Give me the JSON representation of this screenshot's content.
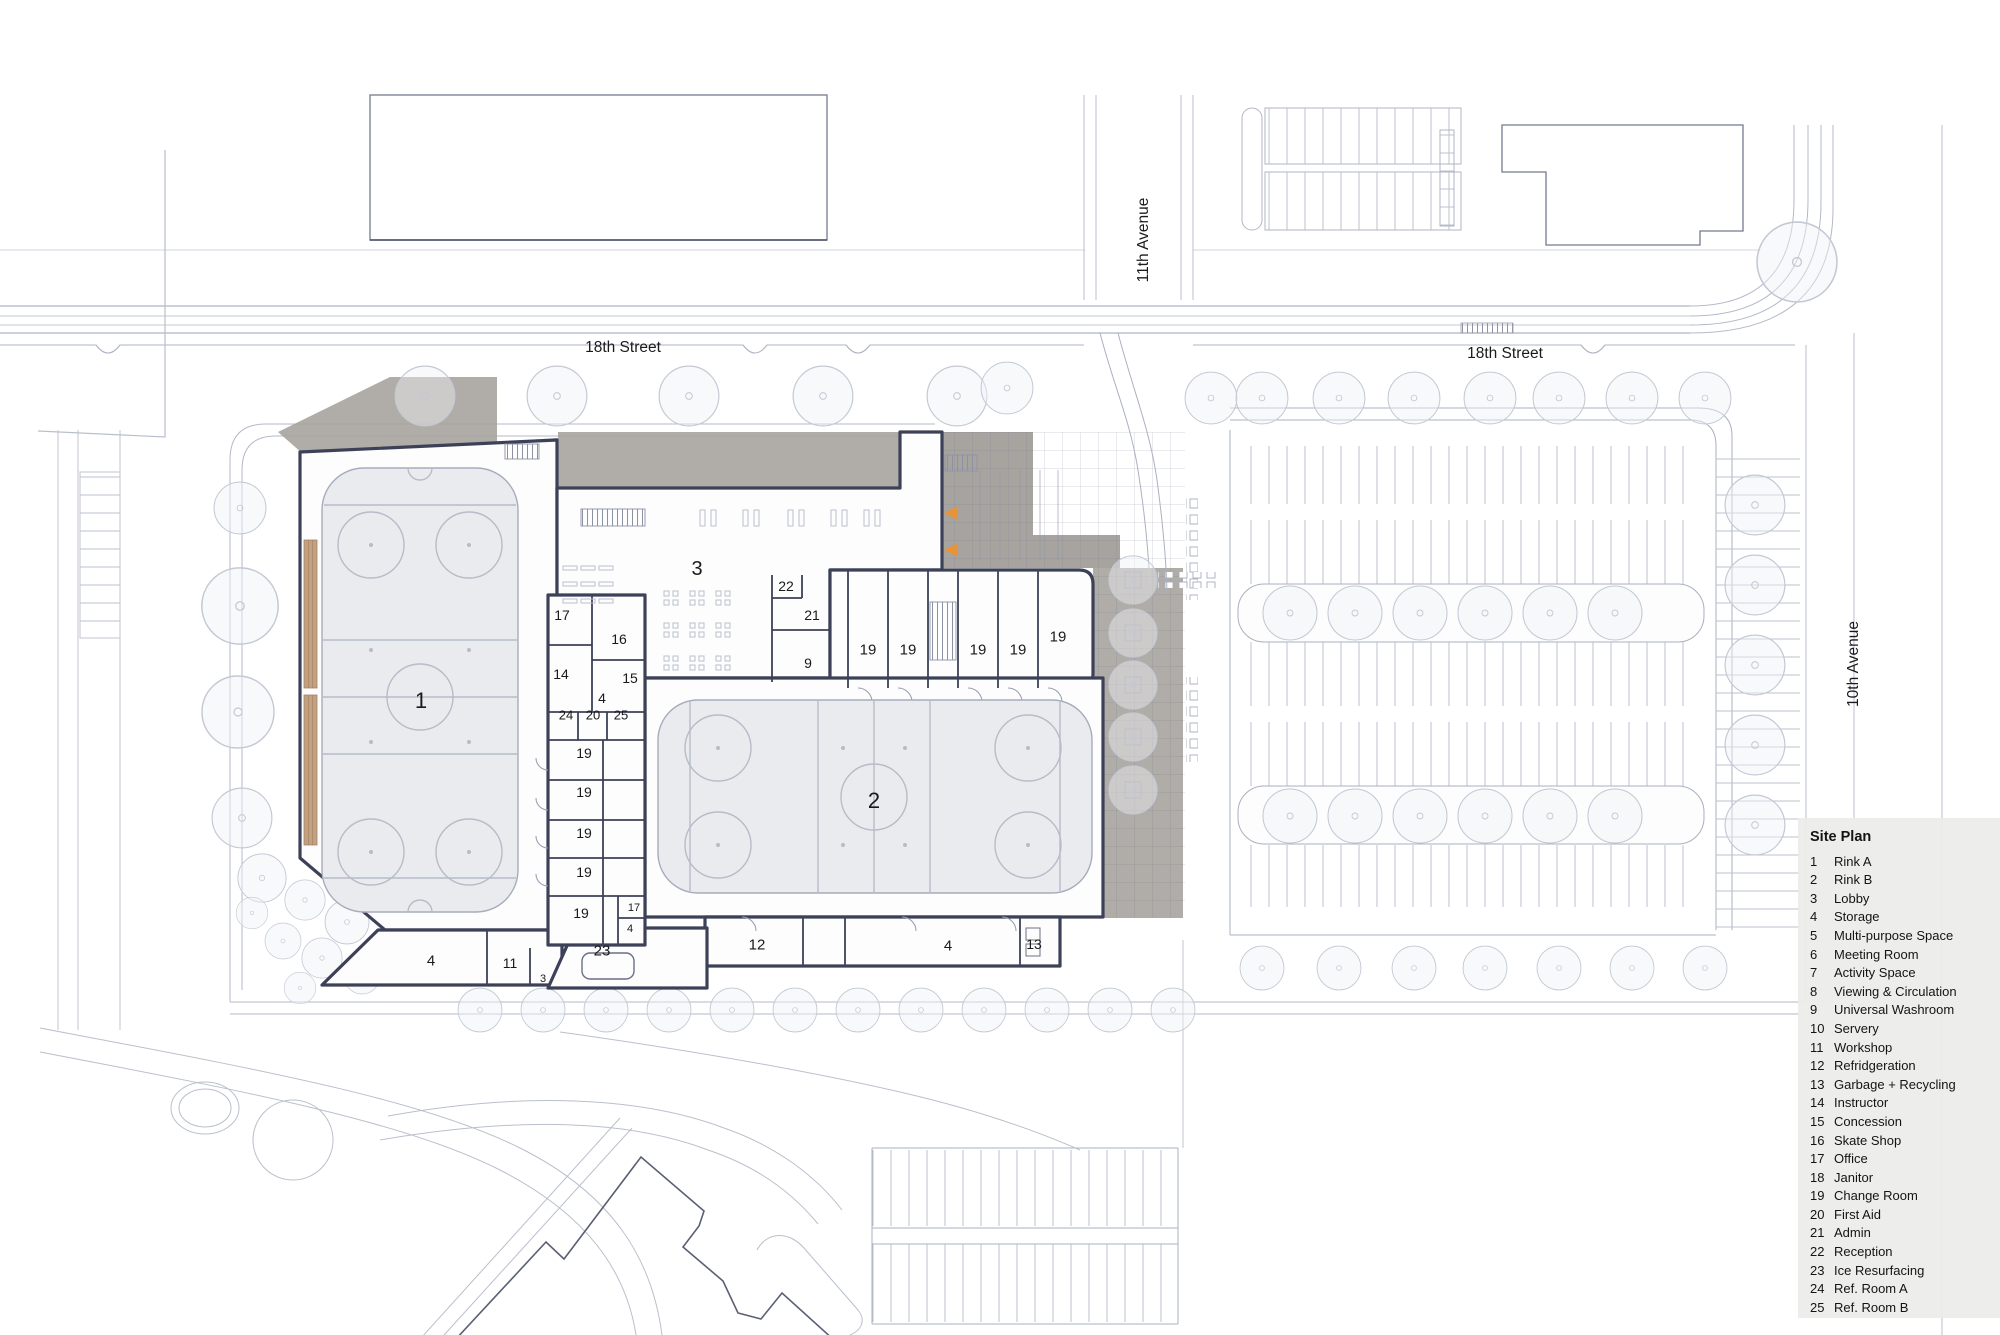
{
  "legend": {
    "title": "Site Plan",
    "items": [
      [
        "1",
        "Rink A"
      ],
      [
        "2",
        "Rink B"
      ],
      [
        "3",
        "Lobby"
      ],
      [
        "4",
        "Storage"
      ],
      [
        "5",
        "Multi-purpose Space"
      ],
      [
        "6",
        "Meeting Room"
      ],
      [
        "7",
        "Activity Space"
      ],
      [
        "8",
        "Viewing & Circulation"
      ],
      [
        "9",
        "Universal Washroom"
      ],
      [
        "10",
        "Servery"
      ],
      [
        "11",
        "Workshop"
      ],
      [
        "12",
        "Refridgeration"
      ],
      [
        "13",
        "Garbage + Recycling"
      ],
      [
        "14",
        "Instructor"
      ],
      [
        "15",
        "Concession"
      ],
      [
        "16",
        "Skate Shop"
      ],
      [
        "17",
        "Office"
      ],
      [
        "18",
        "Janitor"
      ],
      [
        "19",
        "Change Room"
      ],
      [
        "20",
        "First Aid"
      ],
      [
        "21",
        "Admin"
      ],
      [
        "22",
        "Reception"
      ],
      [
        "23",
        "Ice Resurfacing"
      ],
      [
        "24",
        "Ref. Room A"
      ],
      [
        "25",
        "Ref. Room B"
      ]
    ]
  },
  "streets": {
    "s18_left": "18th Street",
    "s18_right": "18th Street",
    "ave11": "11th Avenue",
    "ave10": "10th Avenue"
  },
  "rooms": [
    {
      "n": "1",
      "x": 421,
      "y": 700,
      "s": 22
    },
    {
      "n": "2",
      "x": 874,
      "y": 800,
      "s": 22
    },
    {
      "n": "3",
      "x": 697,
      "y": 568,
      "s": 20
    },
    {
      "n": "22",
      "x": 786,
      "y": 586,
      "s": 14
    },
    {
      "n": "21",
      "x": 812,
      "y": 615,
      "s": 14
    },
    {
      "n": "9",
      "x": 808,
      "y": 663,
      "s": 14
    },
    {
      "n": "19",
      "x": 868,
      "y": 649,
      "s": 15
    },
    {
      "n": "19",
      "x": 908,
      "y": 649,
      "s": 15
    },
    {
      "n": "19",
      "x": 978,
      "y": 649,
      "s": 15
    },
    {
      "n": "19",
      "x": 1018,
      "y": 649,
      "s": 15
    },
    {
      "n": "19",
      "x": 1058,
      "y": 636,
      "s": 15
    },
    {
      "n": "17",
      "x": 562,
      "y": 615,
      "s": 14
    },
    {
      "n": "16",
      "x": 619,
      "y": 639,
      "s": 14
    },
    {
      "n": "14",
      "x": 561,
      "y": 674,
      "s": 14
    },
    {
      "n": "15",
      "x": 630,
      "y": 678,
      "s": 14
    },
    {
      "n": "4",
      "x": 602,
      "y": 698,
      "s": 14
    },
    {
      "n": "24",
      "x": 566,
      "y": 715,
      "s": 13
    },
    {
      "n": "20",
      "x": 593,
      "y": 715,
      "s": 13
    },
    {
      "n": "25",
      "x": 621,
      "y": 715,
      "s": 13
    },
    {
      "n": "19",
      "x": 584,
      "y": 753,
      "s": 14
    },
    {
      "n": "19",
      "x": 584,
      "y": 792,
      "s": 14
    },
    {
      "n": "19",
      "x": 584,
      "y": 833,
      "s": 14
    },
    {
      "n": "19",
      "x": 584,
      "y": 872,
      "s": 14
    },
    {
      "n": "19",
      "x": 581,
      "y": 913,
      "s": 14
    },
    {
      "n": "17",
      "x": 634,
      "y": 907,
      "s": 11
    },
    {
      "n": "4",
      "x": 630,
      "y": 928,
      "s": 11
    },
    {
      "n": "4",
      "x": 431,
      "y": 960,
      "s": 15
    },
    {
      "n": "11",
      "x": 510,
      "y": 963,
      "s": 14
    },
    {
      "n": "3",
      "x": 543,
      "y": 978,
      "s": 11
    },
    {
      "n": "23",
      "x": 602,
      "y": 950,
      "s": 15
    },
    {
      "n": "12",
      "x": 757,
      "y": 944,
      "s": 15
    },
    {
      "n": "4",
      "x": 948,
      "y": 945,
      "s": 15
    },
    {
      "n": "13",
      "x": 1034,
      "y": 944,
      "s": 14
    }
  ],
  "colors": {
    "wall": "#3d4158",
    "ice": "#e9ebef",
    "plaza_gray": "#a7a39d",
    "accent_orange": "#e8923a",
    "line_light": "#aab1c2",
    "legend_bg": "#ececea",
    "bleacher_tan": "#c2a183"
  }
}
